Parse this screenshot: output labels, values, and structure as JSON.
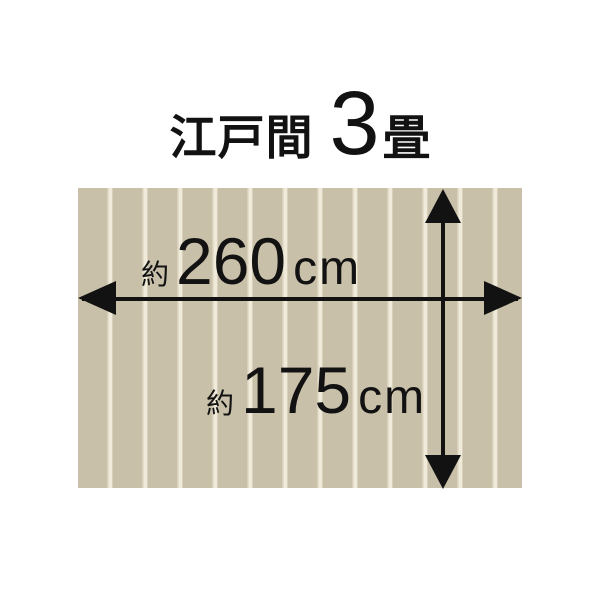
{
  "title": {
    "room_type": "江戸間",
    "mat_count": "3",
    "mat_unit": "畳"
  },
  "dimensions": {
    "width": {
      "approx_prefix": "約",
      "value": "260",
      "unit": "cm"
    },
    "height": {
      "approx_prefix": "約",
      "value": "175",
      "unit": "cm"
    }
  },
  "colors": {
    "background": "#ffffff",
    "flooring_base": "#c9c0a9",
    "flooring_gap_light": "#efead9",
    "flooring_gap_mid": "#d8d0bb",
    "ink": "#121212"
  }
}
